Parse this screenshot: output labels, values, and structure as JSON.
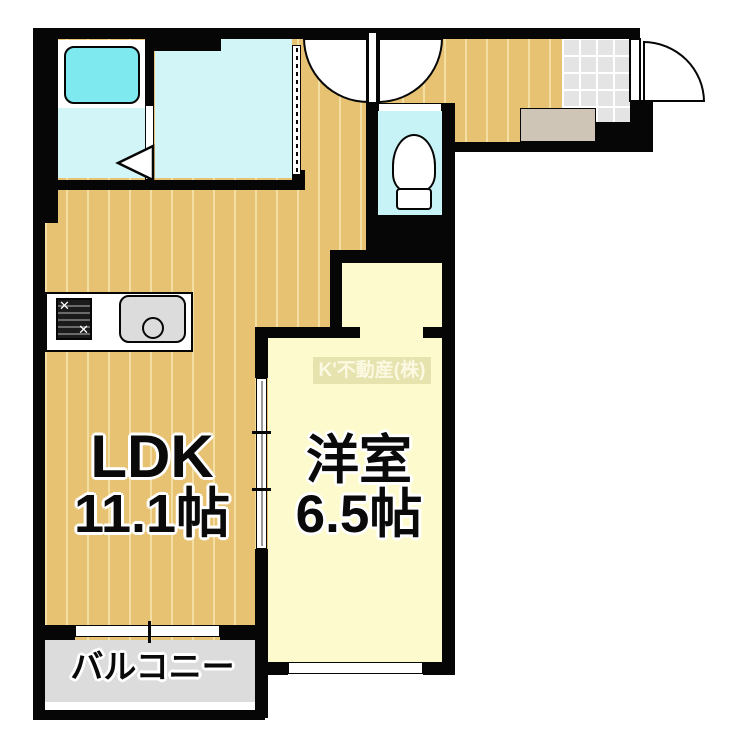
{
  "title": "apartment-floor-plan",
  "rooms": {
    "ldk": {
      "name": "LDK",
      "size": "11.1帖"
    },
    "western_room": {
      "name": "洋室",
      "size": "6.5帖"
    },
    "balcony": {
      "name": "バルコニー"
    }
  },
  "watermark": "K'不動産(株)",
  "fixtures": [
    "bathtub",
    "toilet",
    "kitchen-stove",
    "kitchen-sink",
    "entry-step",
    "entry-tile"
  ],
  "doors": [
    "bath-folding-door",
    "washroom-accordion-door",
    "toilet-swing-door",
    "hall-swing-door",
    "entry-door",
    "ldk-sliding-door"
  ],
  "windows": [
    "balcony-window",
    "western-room-window"
  ],
  "colors": {
    "wall": "#060606",
    "wood_floor": "#e7c273",
    "wood_stripe": "#f3dfa2",
    "bath_cyan": "#d2f6f8",
    "tub_cyan": "#7ee9ef",
    "toilet_cyan": "#c8f3f6",
    "western_room_yellow": "#fdfbcd",
    "balcony_grey": "#dcdcdc",
    "entry_tile_grey": "#e4e4e4",
    "step_beige": "#cfc5b6"
  }
}
